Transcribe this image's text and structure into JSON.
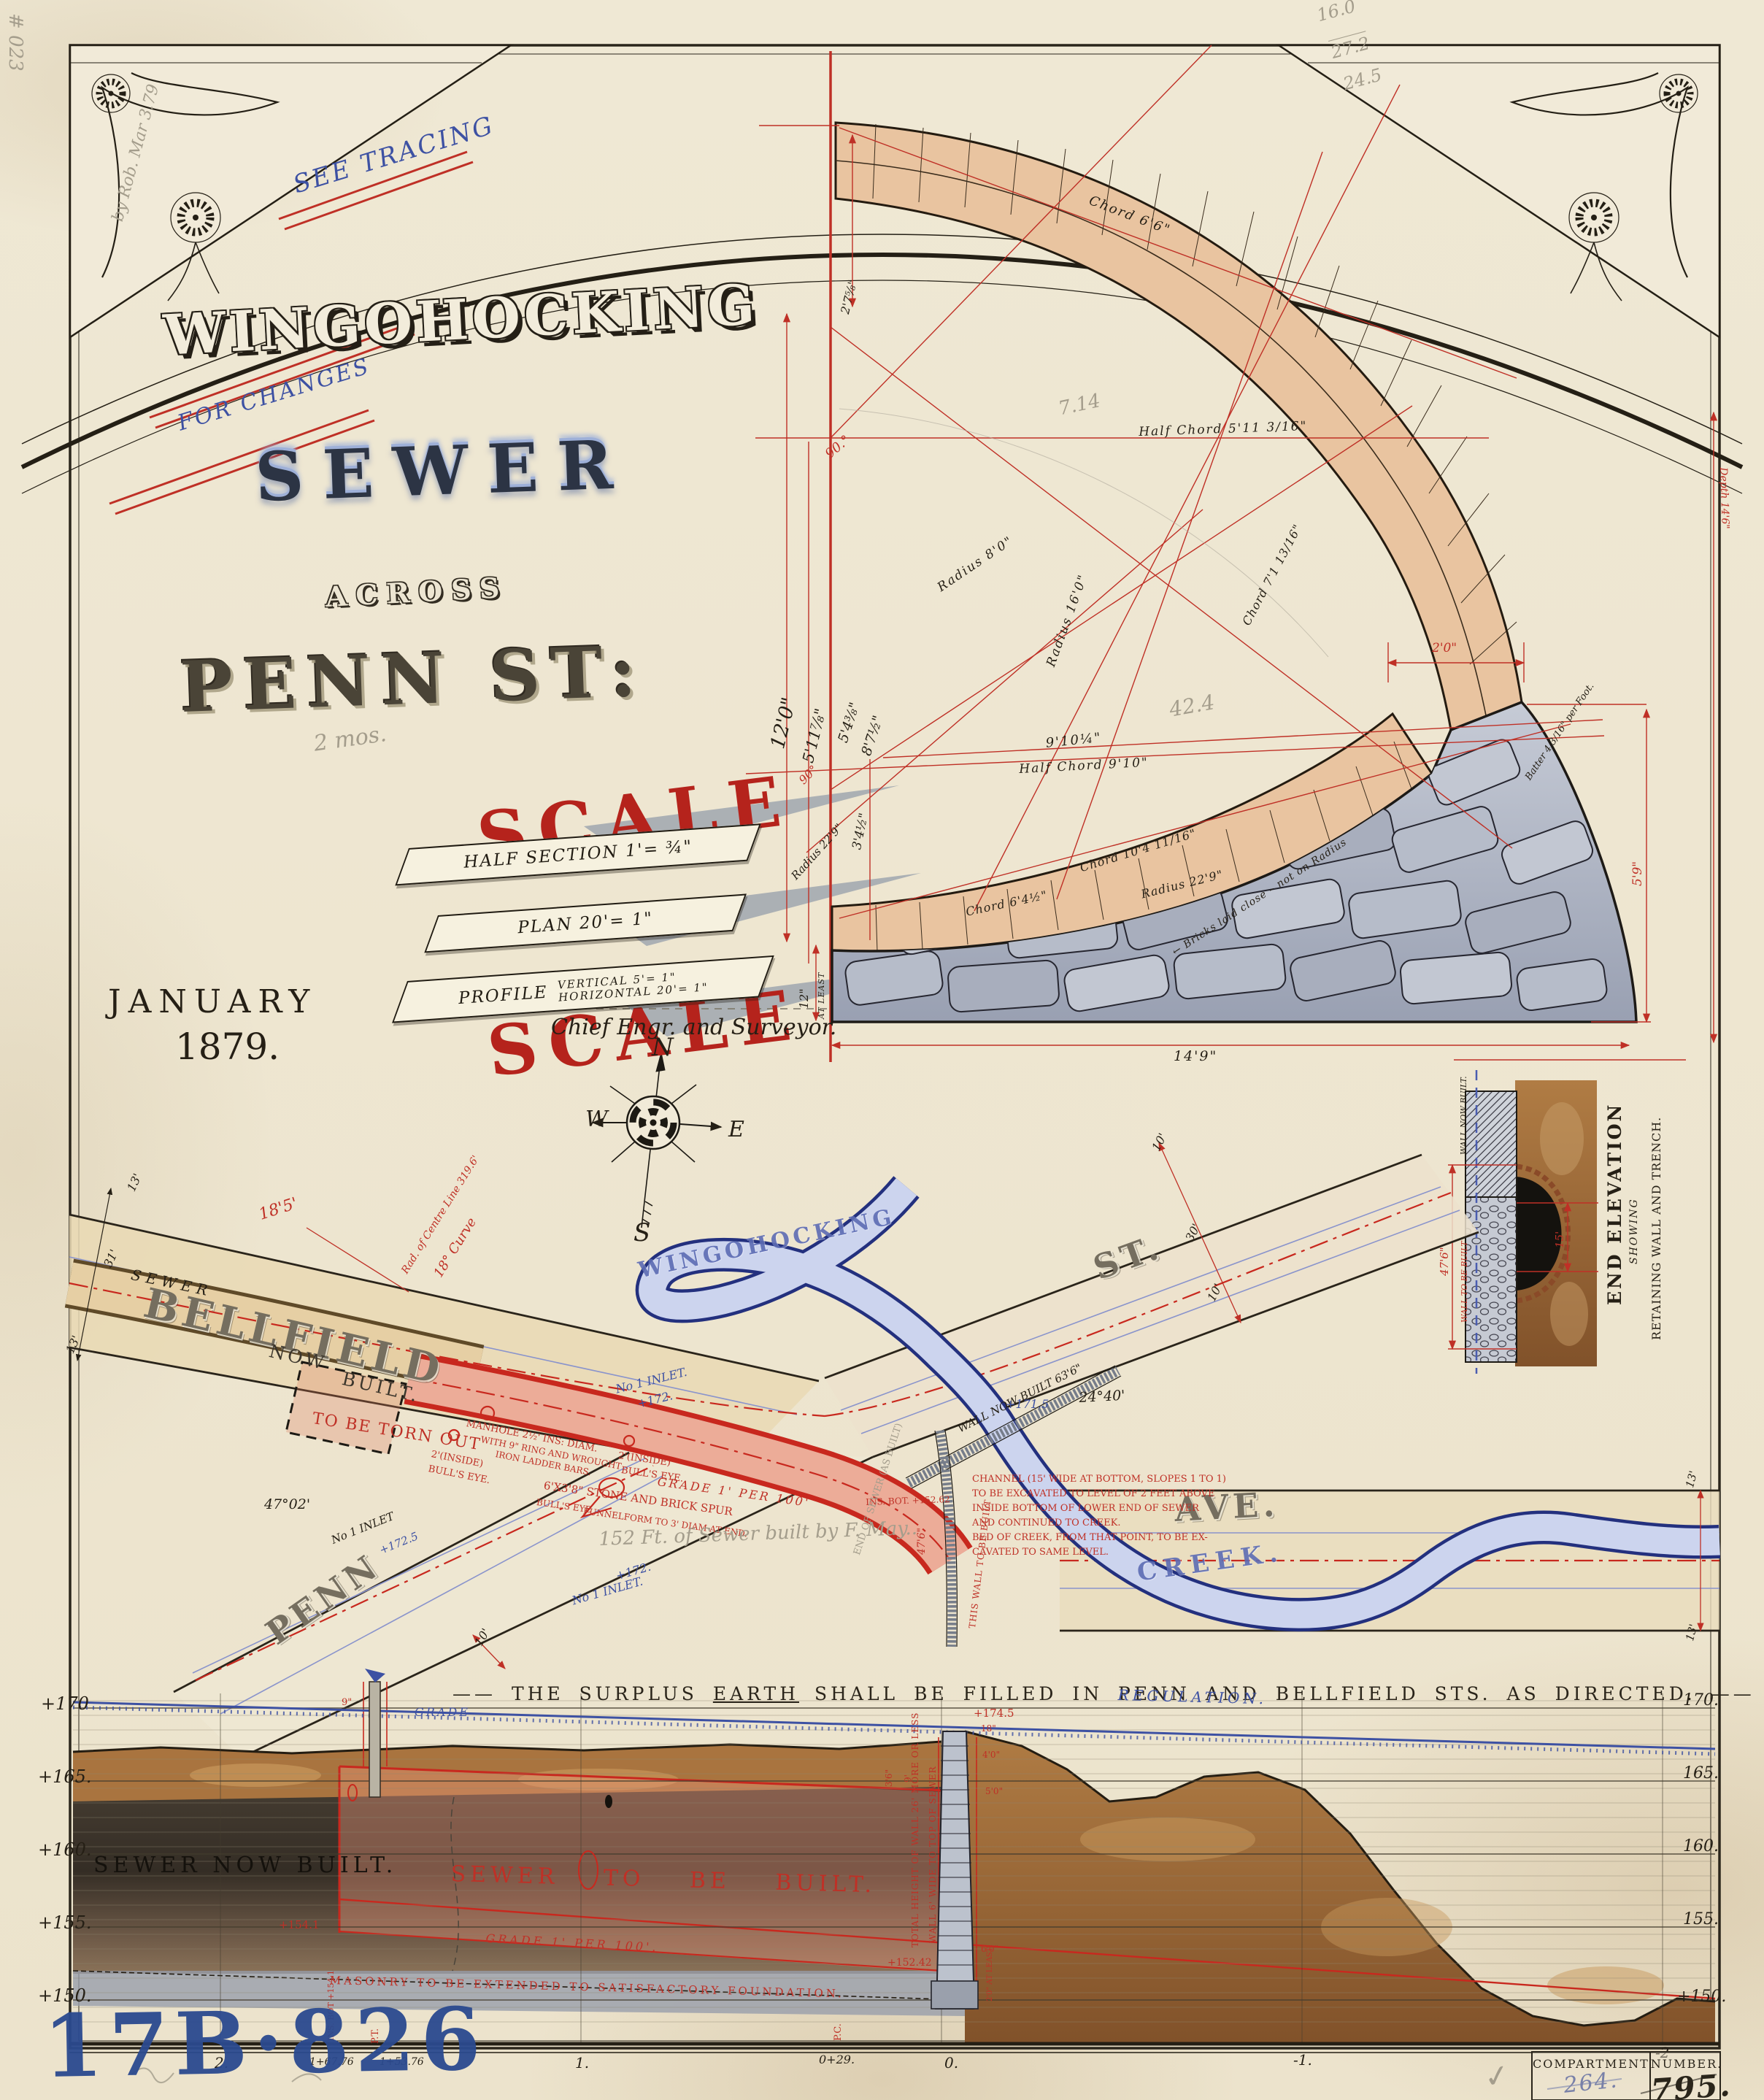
{
  "colors": {
    "red": "#bf3026",
    "blue": "#3d51a3",
    "brick": "#e9c4a0",
    "stone": "#b4bac8",
    "earth": "#a9743f",
    "paper": "#efe8d4",
    "stamp_blue": "#2b4a8f"
  },
  "page": {
    "plate_id": "17B·826",
    "checkmark": "✓"
  },
  "filing": {
    "compartment_label": "COMPARTMENT",
    "compartment_value": "264.",
    "number_label": "NUMBER.",
    "number_value": "795."
  },
  "pencil": {
    "corner_num": "# 023",
    "edge_note": "by Rob. Mar 3.79",
    "arith1": "16.0",
    "arith2": "27.2",
    "arith3": "24.5",
    "n1": "7.14",
    "n2": "42.4",
    "months": "2 mos.",
    "built_note": "152 Ft. of Sewer built by F. May..",
    "end_of_sewer": "END OF SEWER (AS BUILT)"
  },
  "title": {
    "see_tracing": "SEE TRACING",
    "main": "WINGOHOCKING",
    "for_changes": "FOR CHANGES",
    "sub": "SEWER",
    "across": "ACROSS",
    "street": "PENN ST:",
    "date1": "JANUARY",
    "date2": "1879.",
    "signature": "Chief Engr. and Surveyor.",
    "scale_word1": "SCALE",
    "scale_word2": "SCALE",
    "scale_half_section": "HALF SECTION 1'= ¾\"",
    "scale_plan": "PLAN 20'= 1\"",
    "scale_profile_label": "PROFILE",
    "scale_profile_v": "VERTICAL 5'= 1\"",
    "scale_profile_h": "HORIZONTAL 20'= 1\""
  },
  "compass": {
    "n": "N",
    "s": "S",
    "e": "E",
    "w": "W"
  },
  "section": {
    "chord_6_6": "Chord 6'6\"",
    "half_chord_5_11": "Half Chord 5'11 3/16\"",
    "radius_8": "Radius 8'0\"",
    "radius_16": "Radius 16'0\"",
    "chord_7_1": "Chord 7'1 13/16\"",
    "nine_ten": "9'10¼\"",
    "half_chord_9_10": "Half Chord 9'10\"",
    "chord_10_4": "Chord 10'4 11/16\"",
    "radius_22_9a": "Radius 22'9\"",
    "radius_22_9b": "Radius 22'9\"",
    "bricks_note": "← Bricks laid close – not on Radius",
    "chord_6_4": "Chord 6'4½\"",
    "dim_2_7": "2'7⅝\"",
    "angle_90a": "90.°",
    "angle_90b": "90°",
    "dim_12_0": "12'0\"",
    "dim_5_11": "5'11⅞\"",
    "dim_5_4": "5'4⅜\"",
    "dim_8_7": "8'7½\"",
    "dim_3_4": "3'4½\"",
    "dim_12in": "12\"",
    "dim_12in2": "AT LEAST",
    "dim_2_0": "2'0\"",
    "dim_5_9": "5'9\"",
    "batter": "Batter 4 3/16\" per Foot.",
    "depth": "Depth 14'6\"",
    "width_base": "14'9\""
  },
  "end_elevation": {
    "title": "END ELEVATION",
    "showing": "SHOWING",
    "sub": "RETAINING WALL AND TRENCH.",
    "wall_now": "WALL NOW BUILT.",
    "wall_tbb": "WALL TO BE BUILT",
    "d476": "47'6\"",
    "d15": "15'"
  },
  "plan": {
    "sewer_small": "SEWER",
    "bellfield": "BELLFIELD",
    "now": "NOW",
    "built": "BUILT.",
    "torn": "TO BE TORN OUT",
    "penn": "PENN",
    "st": "ST.",
    "ave": "AVE.",
    "creek": "CREEK.",
    "wingo": "WINGOHOCKING",
    "inlet1a": "No 1 INLET.",
    "inlet1b": "+172.",
    "inlet2a": "+172.",
    "inlet2b": "No 1 INLET.",
    "inlet3a": "No 1 INLET",
    "inlet3b": "+172.5",
    "angle4702": "47°02'",
    "angle2440": "24°40'",
    "d13a": "13'",
    "d31": "31'",
    "d13b": "13'",
    "d10a": "10'",
    "d30": "30'",
    "d10b": "10'",
    "d10c": "10'",
    "d13c": "13'",
    "d13d": "13'",
    "d185": "18'5'",
    "rad1": "Rad. of Centre Line 319.6'",
    "rad2": "18° Curve",
    "manhole1": "MANHOLE 2½' INS: DIAM.",
    "manhole2": "WITH 9\" RING AND WROUGHT",
    "manhole3": "IRON LADDER BARS.",
    "bulls1a": "2'(INSIDE)",
    "bulls1b": "BULL'S EYE.",
    "bulls2a": "2'(INSIDE)",
    "bulls2b": "BULL'S EYE.",
    "grade_note": "GRADE 1' PER 100'",
    "spur1": "6'X3'8\" STONE AND BRICK SPUR",
    "spur2": "BULL'S EYE",
    "spur3": "FUNNELFORM TO 3' DIAM AT END.",
    "wall_now_built": "WALL NOW BUILT 63'6\"",
    "level_1715": "+171.5",
    "level_1745": "+174.5",
    "ins_bot": "INS. BOT. +152.62",
    "this_wall": "THIS WALL TO BE BUILT",
    "d476": "47'6\"",
    "channel": [
      "CHANNEL (15' WIDE AT BOTTOM, SLOPES 1 TO 1)",
      "TO BE EXCAVATED TO LEVEL OF 2 FEET ABOVE",
      "INSIDE BOTTOM OF LOWER END OF SEWER",
      "AND CONTINUED TO CREEK.",
      "BED OF CREEK, FROM THAT POINT, TO BE EX-",
      "CAVATED TO SAME LEVEL."
    ],
    "caption_pre": "——  THE SURPLUS ",
    "caption_word": "EARTH",
    "caption_post": " SHALL BE FILLED IN PENN AND BELLFIELD STS. AS DIRECTED.  ——"
  },
  "profile": {
    "elev_left": [
      "+170",
      "+165.",
      "+160.",
      "+155.",
      "+150."
    ],
    "elev_right": [
      "170.",
      "165.",
      "160.",
      "155.",
      "+150."
    ],
    "stations": [
      "2.",
      "1+67.76",
      "1+53.76",
      "1.",
      "0+29.",
      "0.",
      "-1.",
      "-2"
    ],
    "pt": "P.T.",
    "pc": "P.C.",
    "insbot154": "INS. BOT +154.1",
    "grade_blue": "GRADE",
    "regulation": "REGULATION.",
    "now_built": "SEWER NOW BUILT.",
    "to_be_built": "SEWER  TO  BE  BUILT.",
    "grade_red": "GRADE 1' PER 100'.",
    "masonry": "MASONRY TO BE EXTENDED TO SATISFACTORY FOUNDATION.",
    "total_height": "TOTAL HEIGHT OF WALL 26' MORE OR LESS",
    "wall6": "WALL 6' WIDE TO TOP OF SEWER",
    "d2at": "2'0\" AT LEAST",
    "l1745": "+174.5",
    "l1541": "+154.1",
    "l15242": "+152.42",
    "d36": "3'6\"",
    "d9": "9'",
    "d18": "18\"",
    "d40": "4'0\"",
    "d50": "5'0\"",
    "d60": "6'0\"",
    "d9in": "9\""
  }
}
